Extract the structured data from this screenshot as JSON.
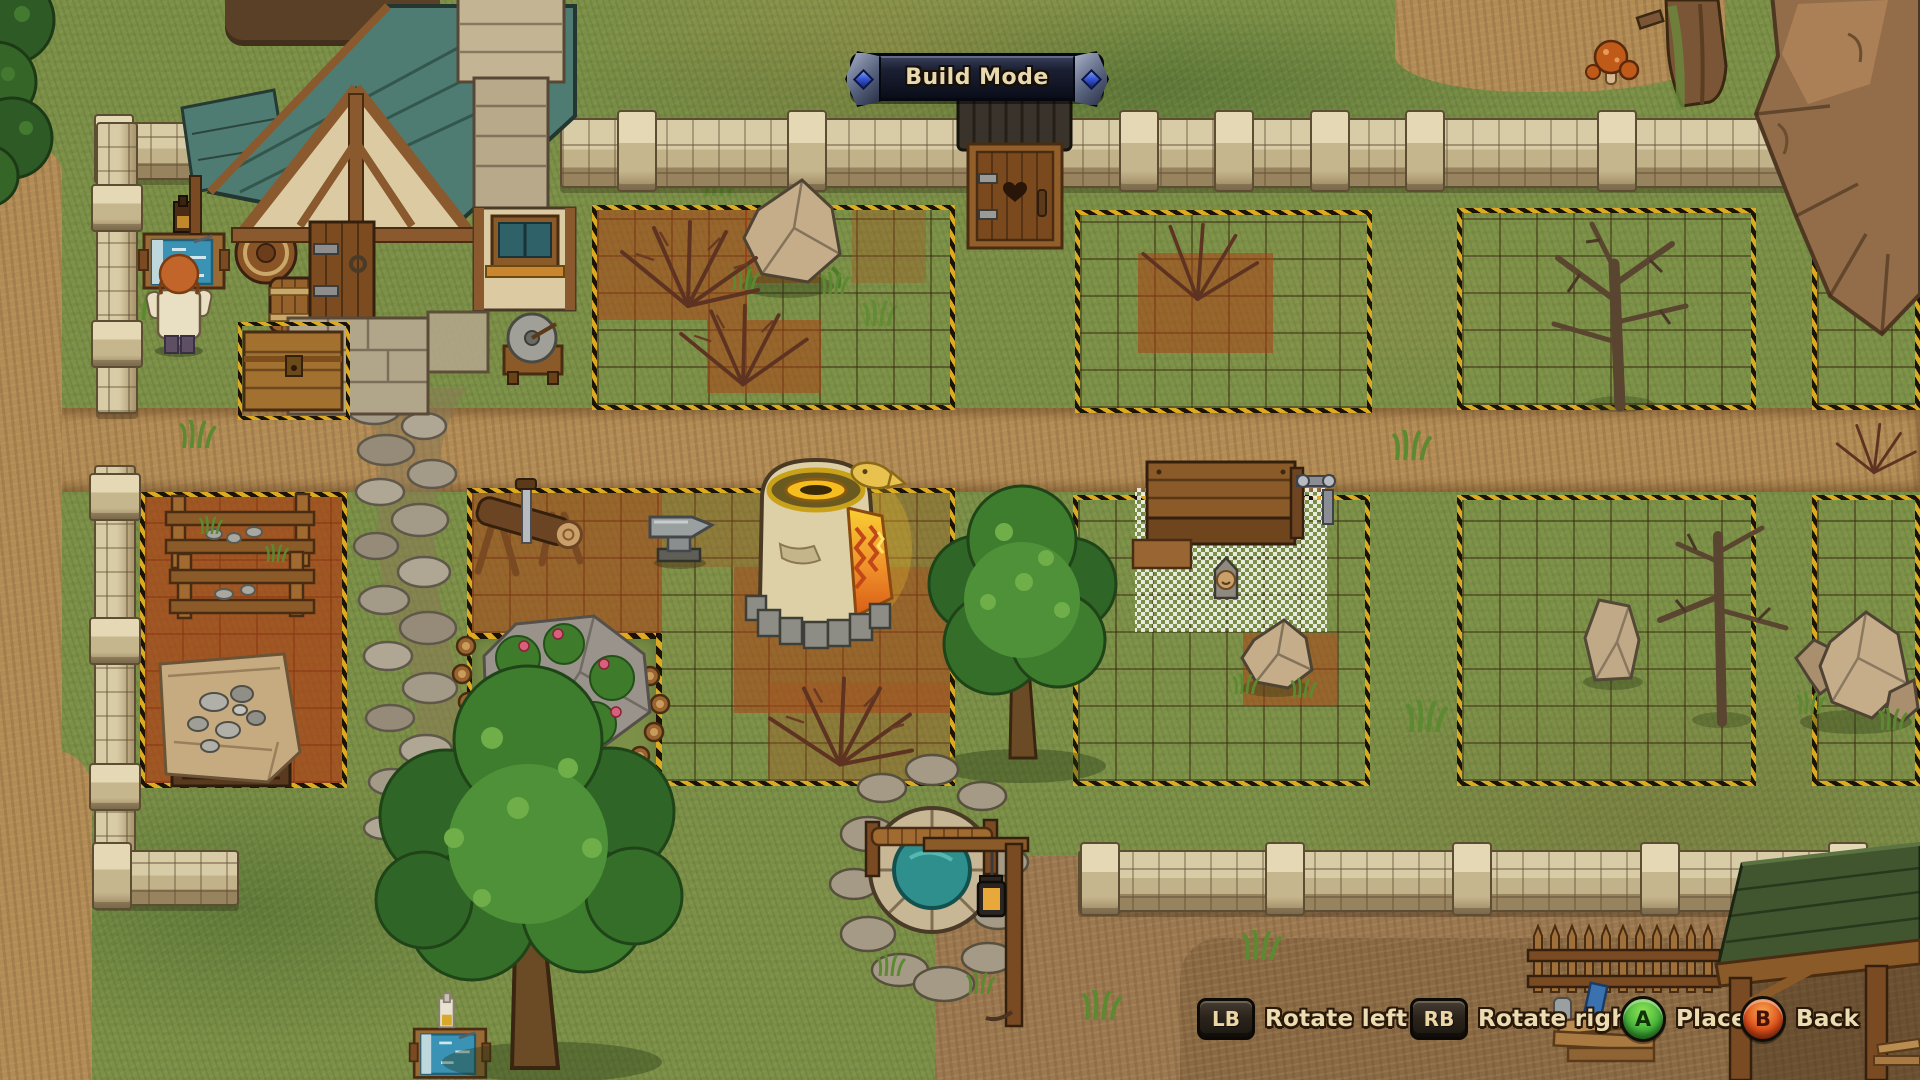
{
  "hud": {
    "banner_label": "Build Mode",
    "hints": [
      {
        "key": "LB",
        "action": "Rotate left"
      },
      {
        "key": "RB",
        "action": "Rotate right"
      },
      {
        "key": "A",
        "action": "Place"
      },
      {
        "key": "B",
        "action": "Back"
      }
    ]
  },
  "colors": {
    "caution_stripe_yellow": "#dcab22",
    "caution_stripe_black": "#191309",
    "grass_base": "#7d9048",
    "dirt_road": "#b28b55",
    "tilled_soil_red": "#ac3e14",
    "house_roof_teal": "#4e7b72",
    "shed_roof_green": "#41562f",
    "well_water_teal": "#2e8f8c",
    "banner_bg_dark": "#12172a",
    "banner_gem_blue": "#3558d6",
    "button_a_green": "#46b33a",
    "button_b_red": "#dd4f1b",
    "hint_text_cream": "#ecdcb2"
  },
  "scene": {
    "objects": [
      "house",
      "porch",
      "outhouse",
      "keeper-character",
      "drafting-table",
      "barrels",
      "storage-chest",
      "grindstone",
      "stone-fences",
      "build-plots",
      "tilled-soil-tiles",
      "boulder",
      "dead-bushes",
      "dead-trees",
      "sawhorse",
      "anvil",
      "furnace",
      "timber-racks",
      "covered-pallet",
      "rose-rock",
      "cobblestone-path",
      "oak-trees",
      "workbench-placement-ghost",
      "stone-idol",
      "standing-stone",
      "well",
      "lantern-post",
      "mushrooms",
      "cliff-rocks",
      "shed-roof",
      "picket-fence",
      "woodpile",
      "drafting-table-2"
    ]
  }
}
